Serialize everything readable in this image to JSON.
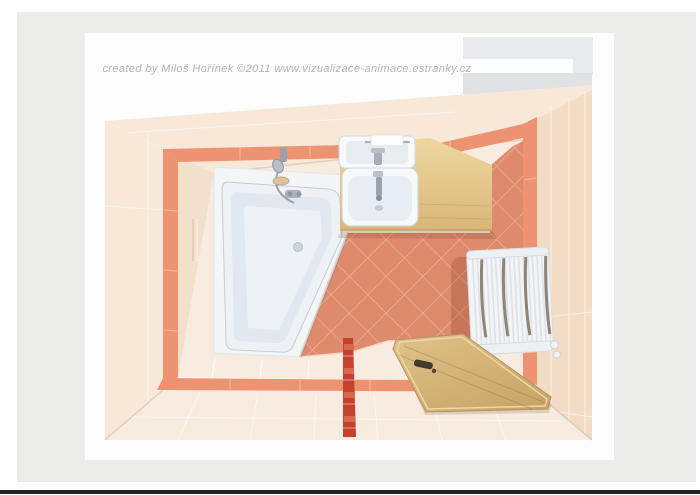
{
  "watermark": {
    "text": "created by Miloš Hořínek ©2011 www.vizualizace-animace.estranky.cz"
  },
  "colors": {
    "page-bg": "#ffffff",
    "workspace-bg": "#ececeb",
    "canvas-bg": "#fdfdfd",
    "watermark-text": "#b4b4b6",
    "bottom-line": "#232323",
    "wall-cream": "#f7e8d8",
    "wall-cream-dark": "#f2dcc6",
    "wall-cream-inner": "#f3e0cc",
    "stripe-salmon": "#ee9372",
    "floor-salmon": "#dd8a6d",
    "floor-salmon-grout": "#ecb096",
    "floor-cream": "#f7ecdf",
    "floor-grout": "#ffffff",
    "ceiling-gray": "#dfe1e3",
    "ceiling-gray-light": "#e9eaeb",
    "tub-white": "#eef1f5",
    "tub-rim": "#e2e8f0",
    "tub-stroke": "#c6cdd7",
    "platform-white": "#f3f5f7",
    "chrome": "#9aa2ac",
    "wood-counter": "#e8cb92",
    "wood-counter-dark": "#d9b578",
    "wood-door": "#d9ba7e",
    "wood-door-dark": "#c6a264",
    "radiator-white": "#f2f4f6",
    "radiator-line": "#dde2e7",
    "radiator-slot": "#8d8579",
    "red-stripe": "#c6402e",
    "red-stripe-light": "#d96a52",
    "shadow-warm": "rgba(140,60,40,0.25)"
  }
}
